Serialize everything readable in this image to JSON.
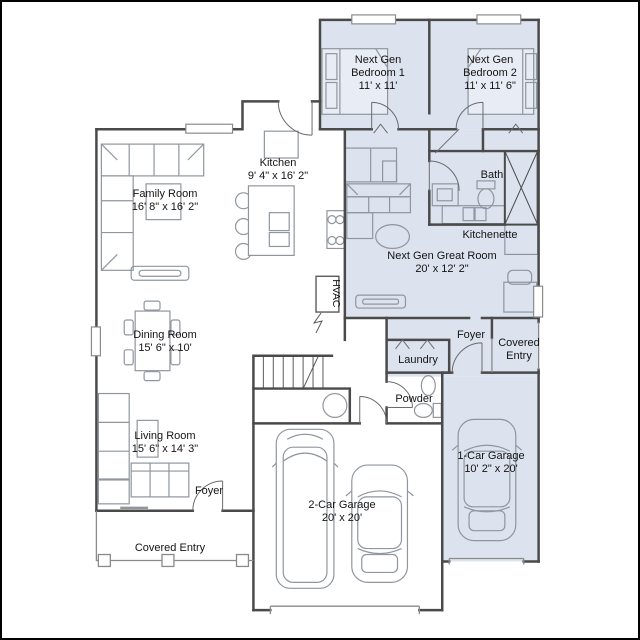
{
  "plan": {
    "type": "floor-plan",
    "colors": {
      "background": "#ffffff",
      "suite_fill": "#dce2ee",
      "wall": "#4a4a4a",
      "furniture": "#8f969e",
      "door": "#6b6b6b",
      "text": "#141414",
      "frame": "#000000"
    },
    "rooms": [
      {
        "id": "next-gen-bedroom-1",
        "name": "Next Gen Bedroom 1",
        "dims": "11' x 11'"
      },
      {
        "id": "next-gen-bedroom-2",
        "name": "Next Gen Bedroom 2",
        "dims": "11' x 11' 6\""
      },
      {
        "id": "kitchen",
        "name": "Kitchen",
        "dims": "9' 4\" x 16' 2\""
      },
      {
        "id": "family-room",
        "name": "Family Room",
        "dims": "16' 8\" x 16' 2\""
      },
      {
        "id": "bath",
        "name": "Bath",
        "dims": ""
      },
      {
        "id": "kitchenette",
        "name": "Kitchenette",
        "dims": ""
      },
      {
        "id": "next-gen-great-room",
        "name": "Next Gen Great Room",
        "dims": "20' x 12' 2\""
      },
      {
        "id": "hvac",
        "name": "HVAC",
        "dims": ""
      },
      {
        "id": "dining-room",
        "name": "Dining Room",
        "dims": "15' 6\" x 10'"
      },
      {
        "id": "foyer-nextgen",
        "name": "Foyer",
        "dims": ""
      },
      {
        "id": "covered-entry-nextgen",
        "name": "Covered Entry",
        "dims": ""
      },
      {
        "id": "laundry",
        "name": "Laundry",
        "dims": ""
      },
      {
        "id": "powder",
        "name": "Powder",
        "dims": ""
      },
      {
        "id": "living-room",
        "name": "Living Room",
        "dims": "15' 6\" x 14' 3\""
      },
      {
        "id": "foyer-main",
        "name": "Foyer",
        "dims": ""
      },
      {
        "id": "covered-entry-main",
        "name": "Covered Entry",
        "dims": ""
      },
      {
        "id": "one-car-garage",
        "name": "1-Car Garage",
        "dims": "10' 2\" x 20'"
      },
      {
        "id": "two-car-garage",
        "name": "2-Car Garage",
        "dims": "20' x 20'"
      }
    ]
  }
}
